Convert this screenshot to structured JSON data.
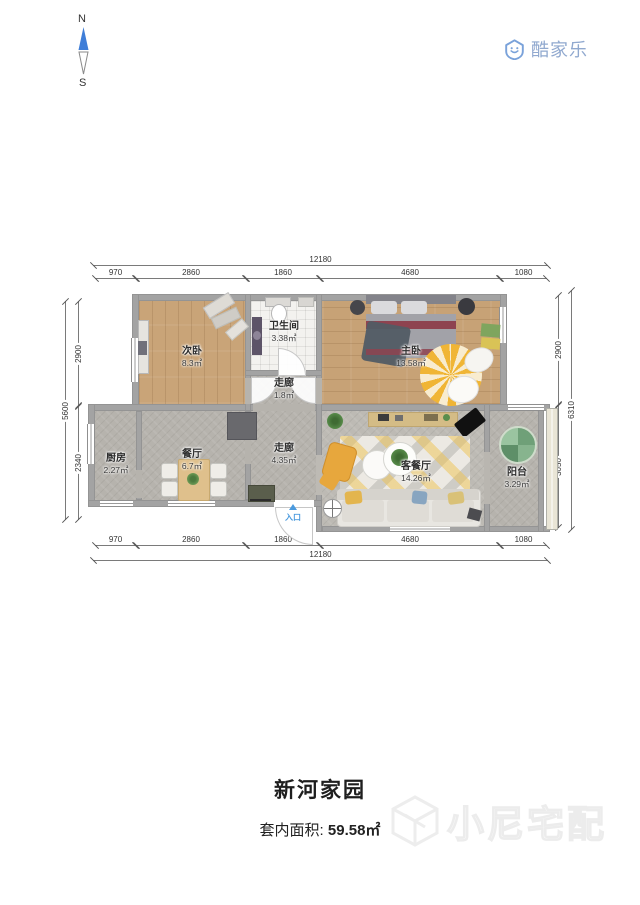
{
  "header": {
    "compass": {
      "north": "N",
      "south": "S"
    },
    "brand": "酷家乐"
  },
  "plan": {
    "rooms": [
      {
        "name": "次卧",
        "area": "8.3㎡"
      },
      {
        "name": "卫生间",
        "area": "3.38㎡"
      },
      {
        "name": "走廊",
        "area": "1.8㎡"
      },
      {
        "name": "主卧",
        "area": "13.58㎡"
      },
      {
        "name": "厨房",
        "area": "2.27㎡"
      },
      {
        "name": "餐厅",
        "area": "6.7㎡"
      },
      {
        "name": "走廊",
        "area": "4.35㎡"
      },
      {
        "name": "客餐厅",
        "area": "14.26㎡"
      },
      {
        "name": "阳台",
        "area": "3.29㎡"
      }
    ],
    "entry": "入口",
    "dims": {
      "top_total": "12180",
      "top_segments": [
        "970",
        "2860",
        "1860",
        "4680",
        "1080"
      ],
      "bottom_segments": [
        "970",
        "2860",
        "1860",
        "4680",
        "1080"
      ],
      "bottom_total": "12180",
      "left_segments": [
        "2900",
        "2340"
      ],
      "left_total": "5600",
      "right_segments": [
        "2900",
        "3050"
      ],
      "right_total": "6310"
    }
  },
  "footer": {
    "title": "新河家园",
    "area_label": "套内面积:",
    "area_value": "59.58㎡",
    "watermark": "小尼宅配"
  },
  "colors": {
    "brand_blue": "#7aa2da",
    "compass_blue": "#3f7ed8",
    "entry_blue": "#4a9ade",
    "wall_gray": "#a3a3a3"
  }
}
